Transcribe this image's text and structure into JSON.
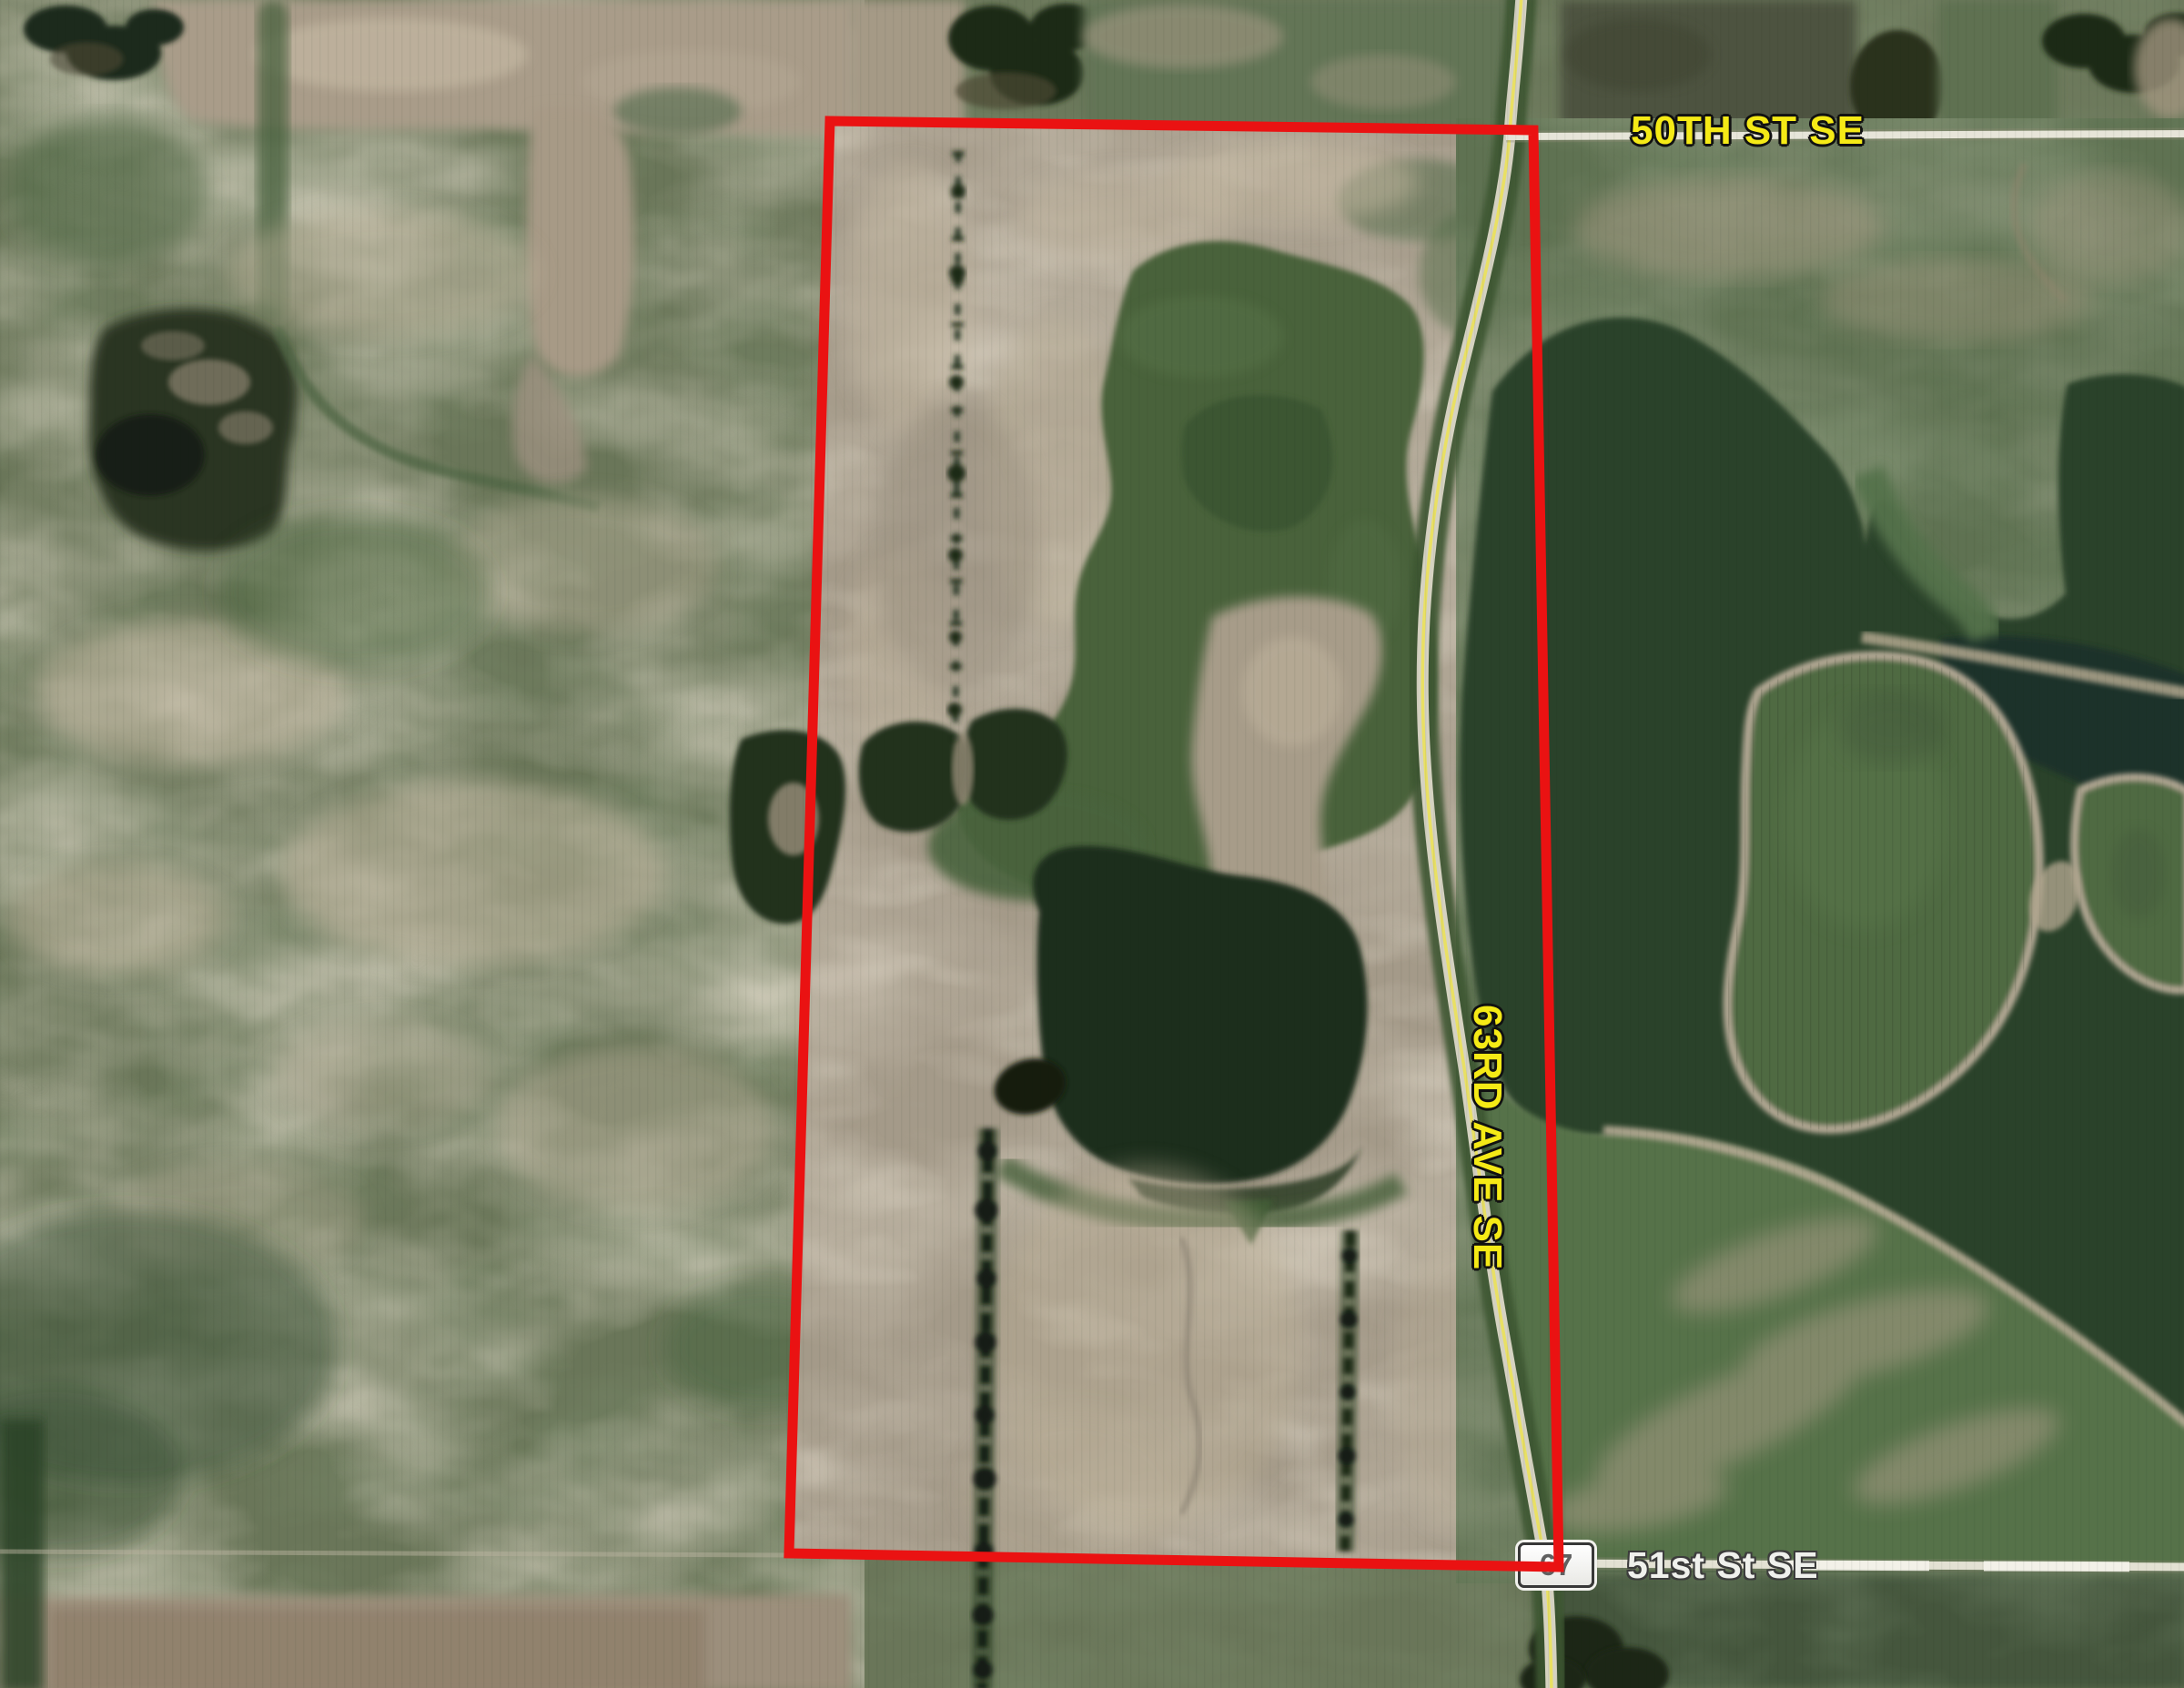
{
  "map": {
    "title": "Aerial parcel map",
    "labels": {
      "road_top": "50TH ST SE",
      "road_side": "63RD AVE SE",
      "road_bottom": "51st St SE",
      "route_shield": "67"
    },
    "colors": {
      "parcel_boundary_red": "#ea1212",
      "road_label_yellow": "#f5ea16",
      "road_label_white": "#eff0ec",
      "shield_background": "#ffffff",
      "shield_text": "#606060",
      "road_surface": "#d5d2c1",
      "road_centerline_yellow": "#e9e063",
      "bare_field_tan": "#a49a89",
      "pasture_green": "#6a7659",
      "marsh_green": "#48623b",
      "dark_crop_green": "#2c4229",
      "dark_water": "#1e2d1e",
      "tree_line_dark": "#1d2b19"
    }
  }
}
